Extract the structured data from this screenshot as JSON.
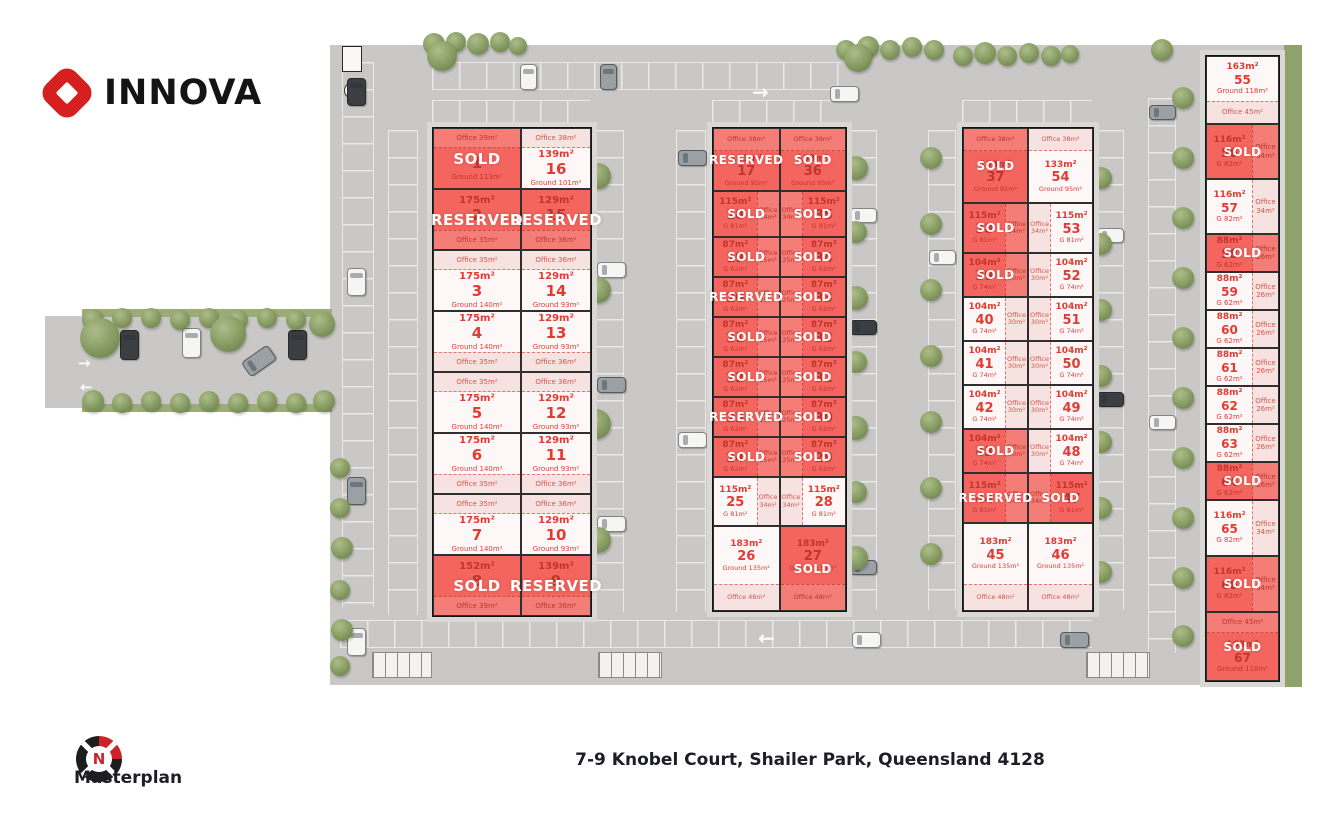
{
  "brand": {
    "name": "INNOVA"
  },
  "plan": {
    "label": "Masterplan",
    "address": "7-9 Knobel Court, Shailer Park, Queensland 4128",
    "compass": "N"
  },
  "statusLabels": {
    "sold": "SOLD",
    "reserved": "RESERVED"
  },
  "colors": {
    "sold": "#f3655e",
    "available": "#fdf8f7",
    "accentText": "#e23b33",
    "brandRed": "#d6201f"
  },
  "buildings": [
    {
      "name": "building-1",
      "rows": [
        [
          {
            "num": "1",
            "area": "",
            "ground": "Ground 113m²",
            "office": "Office 39m²",
            "status": "sold",
            "officePos": "top"
          },
          {
            "num": "16",
            "area": "139m²",
            "ground": "Ground 101m²",
            "office": "Office 38m²",
            "status": "available",
            "officePos": "top"
          }
        ],
        [
          {
            "num": "2",
            "area": "175m²",
            "ground": "",
            "office": "Office 35m²",
            "status": "reserved",
            "officePos": "bottom"
          },
          {
            "num": "15",
            "area": "129m²",
            "ground": "",
            "office": "Office 36m²",
            "status": "reserved",
            "officePos": "bottom"
          }
        ],
        [
          {
            "num": "3",
            "area": "175m²",
            "ground": "Ground 140m²",
            "office": "Office 35m²",
            "status": "available",
            "officePos": "top"
          },
          {
            "num": "14",
            "area": "129m²",
            "ground": "Ground 93m²",
            "office": "Office 36m²",
            "status": "available",
            "officePos": "top"
          }
        ],
        [
          {
            "num": "4",
            "area": "175m²",
            "ground": "Ground 140m²",
            "office": "Office 35m²",
            "status": "available",
            "officePos": "bottom"
          },
          {
            "num": "13",
            "area": "129m²",
            "ground": "Ground 93m²",
            "office": "Office 36m²",
            "status": "available",
            "officePos": "bottom"
          }
        ],
        [
          {
            "num": "5",
            "area": "175m²",
            "ground": "Ground 140m²",
            "office": "Office 35m²",
            "status": "available",
            "officePos": "top"
          },
          {
            "num": "12",
            "area": "129m²",
            "ground": "Ground 93m²",
            "office": "Office 36m²",
            "status": "available",
            "officePos": "top"
          }
        ],
        [
          {
            "num": "6",
            "area": "175m²",
            "ground": "Ground 140m²",
            "office": "Office 35m²",
            "status": "available",
            "officePos": "bottom"
          },
          {
            "num": "11",
            "area": "129m²",
            "ground": "Ground 93m²",
            "office": "Office 36m²",
            "status": "available",
            "officePos": "bottom"
          }
        ],
        [
          {
            "num": "7",
            "area": "175m²",
            "ground": "Ground 140m²",
            "office": "Office 35m²",
            "status": "available",
            "officePos": "top"
          },
          {
            "num": "10",
            "area": "129m²",
            "ground": "Ground 93m²",
            "office": "Office 36m²",
            "status": "available",
            "officePos": "top"
          }
        ],
        [
          {
            "num": "8",
            "area": "152m²",
            "ground": "",
            "office": "Office 39m²",
            "status": "sold",
            "officePos": "bottom"
          },
          {
            "num": "9",
            "area": "139m²",
            "ground": "",
            "office": "Office 36m²",
            "status": "reserved",
            "officePos": "bottom"
          }
        ]
      ]
    },
    {
      "name": "building-2",
      "rows": [
        [
          {
            "num": "17",
            "area": "133m²",
            "ground": "Ground 95m²",
            "office": "Office 38m²",
            "status": "reserved",
            "officePos": "top"
          },
          {
            "num": "36",
            "area": "133m²",
            "ground": "Ground 95m²",
            "office": "Office 38m²",
            "status": "sold",
            "officePos": "top"
          }
        ],
        [
          {
            "num": "18",
            "area": "115m²",
            "ground": "G 81m²",
            "office": "Office 34m²",
            "status": "sold",
            "officePos": "right"
          },
          {
            "num": "35",
            "area": "115m²",
            "ground": "G 81m²",
            "office": "Office 34m²",
            "status": "sold",
            "officePos": "left"
          }
        ],
        [
          {
            "num": "19",
            "area": "87m²",
            "ground": "G 62m²",
            "office": "Office 25m²",
            "status": "sold",
            "officePos": "right"
          },
          {
            "num": "34",
            "area": "87m²",
            "ground": "G 62m²",
            "office": "Office 25m²",
            "status": "sold",
            "officePos": "left"
          }
        ],
        [
          {
            "num": "20",
            "area": "87m²",
            "ground": "G 62m²",
            "office": "Office 25m²",
            "status": "reserved",
            "officePos": "right"
          },
          {
            "num": "33",
            "area": "87m²",
            "ground": "G 62m²",
            "office": "Office 25m²",
            "status": "sold",
            "officePos": "left"
          }
        ],
        [
          {
            "num": "21",
            "area": "87m²",
            "ground": "G 62m²",
            "office": "Office 25m²",
            "status": "sold",
            "officePos": "right"
          },
          {
            "num": "32",
            "area": "87m²",
            "ground": "G 62m²",
            "office": "Office 25m²",
            "status": "sold",
            "officePos": "left"
          }
        ],
        [
          {
            "num": "22",
            "area": "87m²",
            "ground": "G 62m²",
            "office": "Office 25m²",
            "status": "sold",
            "officePos": "right"
          },
          {
            "num": "31",
            "area": "87m²",
            "ground": "G 62m²",
            "office": "Office 25m²",
            "status": "sold",
            "officePos": "left"
          }
        ],
        [
          {
            "num": "23",
            "area": "87m²",
            "ground": "G 62m²",
            "office": "Office 25m²",
            "status": "reserved",
            "officePos": "right"
          },
          {
            "num": "30",
            "area": "87m²",
            "ground": "G 62m²",
            "office": "Office 25m²",
            "status": "sold",
            "officePos": "left"
          }
        ],
        [
          {
            "num": "24",
            "area": "87m²",
            "ground": "G 62m²",
            "office": "Office 25m²",
            "status": "sold",
            "officePos": "right"
          },
          {
            "num": "29",
            "area": "87m²",
            "ground": "G 62m²",
            "office": "Office 25m²",
            "status": "sold",
            "officePos": "left"
          }
        ],
        [
          {
            "num": "25",
            "area": "115m²",
            "ground": "G 81m²",
            "office": "Office 34m²",
            "status": "available",
            "officePos": "right"
          },
          {
            "num": "28",
            "area": "115m²",
            "ground": "G 81m²",
            "office": "Office 34m²",
            "status": "available",
            "officePos": "left"
          }
        ],
        [
          {
            "num": "26",
            "area": "183m²",
            "ground": "Ground 135m²",
            "office": "Office 48m²",
            "status": "available",
            "officePos": "bottom"
          },
          {
            "num": "27",
            "area": "183m²",
            "ground": "Ground 135m²",
            "office": "Office 48m²",
            "status": "sold",
            "officePos": "bottom"
          }
        ]
      ]
    },
    {
      "name": "building-3",
      "rows": [
        [
          {
            "num": "37",
            "area": "133m²",
            "ground": "Ground 95m²",
            "office": "Office 38m²",
            "status": "sold",
            "officePos": "top"
          },
          {
            "num": "54",
            "area": "133m²",
            "ground": "Ground 95m²",
            "office": "Office 38m²",
            "status": "available",
            "officePos": "top"
          }
        ],
        [
          {
            "num": "38",
            "area": "115m²",
            "ground": "G 81m²",
            "office": "Office 34m²",
            "status": "sold",
            "officePos": "right"
          },
          {
            "num": "53",
            "area": "115m²",
            "ground": "G 81m²",
            "office": "Office 34m²",
            "status": "available",
            "officePos": "left"
          }
        ],
        [
          {
            "num": "39",
            "area": "104m²",
            "ground": "G 74m²",
            "office": "Office 30m²",
            "status": "sold",
            "officePos": "right"
          },
          {
            "num": "52",
            "area": "104m²",
            "ground": "G 74m²",
            "office": "Office 30m²",
            "status": "available",
            "officePos": "left"
          }
        ],
        [
          {
            "num": "40",
            "area": "104m²",
            "ground": "G 74m²",
            "office": "Office 30m²",
            "status": "available",
            "officePos": "right"
          },
          {
            "num": "51",
            "area": "104m²",
            "ground": "G 74m²",
            "office": "Office 30m²",
            "status": "available",
            "officePos": "left"
          }
        ],
        [
          {
            "num": "41",
            "area": "104m²",
            "ground": "G 74m²",
            "office": "Office 30m²",
            "status": "available",
            "officePos": "right"
          },
          {
            "num": "50",
            "area": "104m²",
            "ground": "G 74m²",
            "office": "Office 30m²",
            "status": "available",
            "officePos": "left"
          }
        ],
        [
          {
            "num": "42",
            "area": "104m²",
            "ground": "G 74m²",
            "office": "Office 30m²",
            "status": "available",
            "officePos": "right"
          },
          {
            "num": "49",
            "area": "104m²",
            "ground": "G 74m²",
            "office": "Office 30m²",
            "status": "available",
            "officePos": "left"
          }
        ],
        [
          {
            "num": "43",
            "area": "104m²",
            "ground": "G 74m²",
            "office": "Office 30m²",
            "status": "sold",
            "officePos": "right"
          },
          {
            "num": "48",
            "area": "104m²",
            "ground": "G 74m²",
            "office": "Office 30m²",
            "status": "available",
            "officePos": "left"
          }
        ],
        [
          {
            "num": "44",
            "area": "115m²",
            "ground": "G 81m²",
            "office": "Office 34m²",
            "status": "reserved",
            "officePos": "right"
          },
          {
            "num": "47",
            "area": "115m²",
            "ground": "G 81m²",
            "office": "Office 34m²",
            "status": "sold",
            "officePos": "left"
          }
        ],
        [
          {
            "num": "45",
            "area": "183m²",
            "ground": "Ground 135m²",
            "office": "Office 48m²",
            "status": "available",
            "officePos": "bottom"
          },
          {
            "num": "46",
            "area": "183m²",
            "ground": "Ground 135m²",
            "office": "Office 48m²",
            "status": "available",
            "officePos": "bottom"
          }
        ]
      ]
    },
    {
      "name": "building-4",
      "rows": [
        [
          {
            "num": "55",
            "area": "163m²",
            "ground": "Ground 118m²",
            "office": "Office 45m²",
            "status": "available",
            "officePos": "bottom"
          }
        ],
        [
          {
            "num": "56",
            "area": "116m²",
            "ground": "G 82m²",
            "office": "Office 34m²",
            "status": "sold",
            "officePos": "right"
          }
        ],
        [
          {
            "num": "57",
            "area": "116m²",
            "ground": "G 82m²",
            "office": "Office 34m²",
            "status": "available",
            "officePos": "right"
          }
        ],
        [
          {
            "num": "58",
            "area": "88m²",
            "ground": "G 62m²",
            "office": "Office 26m²",
            "status": "sold",
            "officePos": "right"
          }
        ],
        [
          {
            "num": "59",
            "area": "88m²",
            "ground": "G 62m²",
            "office": "Office 26m²",
            "status": "available",
            "officePos": "right"
          }
        ],
        [
          {
            "num": "60",
            "area": "88m²",
            "ground": "G 62m²",
            "office": "Office 26m²",
            "status": "available",
            "officePos": "right"
          }
        ],
        [
          {
            "num": "61",
            "area": "88m²",
            "ground": "G 62m²",
            "office": "Office 26m²",
            "status": "available",
            "officePos": "right"
          }
        ],
        [
          {
            "num": "62",
            "area": "88m²",
            "ground": "G 62m²",
            "office": "Office 26m²",
            "status": "available",
            "officePos": "right"
          }
        ],
        [
          {
            "num": "63",
            "area": "88m²",
            "ground": "G 62m²",
            "office": "Office 26m²",
            "status": "available",
            "officePos": "right"
          }
        ],
        [
          {
            "num": "64",
            "area": "88m²",
            "ground": "G 62m²",
            "office": "Office 26m²",
            "status": "sold",
            "officePos": "right"
          }
        ],
        [
          {
            "num": "65",
            "area": "116m²",
            "ground": "G 82m²",
            "office": "Office 34m²",
            "status": "available",
            "officePos": "right"
          }
        ],
        [
          {
            "num": "66",
            "area": "116m²",
            "ground": "G 82m²",
            "office": "Office 34m²",
            "status": "sold",
            "officePos": "right"
          }
        ],
        [
          {
            "num": "67",
            "area": "163m²",
            "ground": "Ground 118m²",
            "office": "Office 45m²",
            "status": "sold",
            "officePos": "top"
          }
        ]
      ]
    }
  ]
}
